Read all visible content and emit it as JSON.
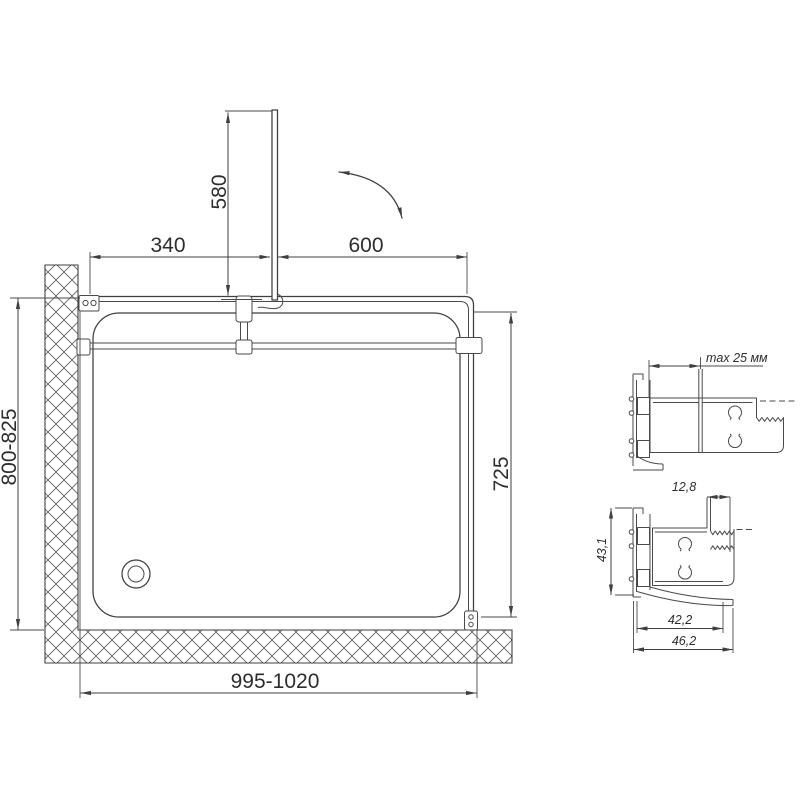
{
  "plan_view": {
    "dim_labels": {
      "door_fixed": "340",
      "door_opening": "600",
      "door_panel": "580",
      "side_depth": "800-825",
      "inner_depth": "725",
      "total_width": "995-1020"
    }
  },
  "detail_views": {
    "wall_profile": {
      "adjustment": "max 25 мм"
    },
    "frame_profile": {
      "glass_slot_width": "12,8",
      "profile_height": "43,1",
      "inner_width": "42,2",
      "outer_width": "46,2"
    }
  },
  "colors": {
    "line": "#3f3f3f",
    "text": "#2d2d2d",
    "background": "#ffffff"
  }
}
